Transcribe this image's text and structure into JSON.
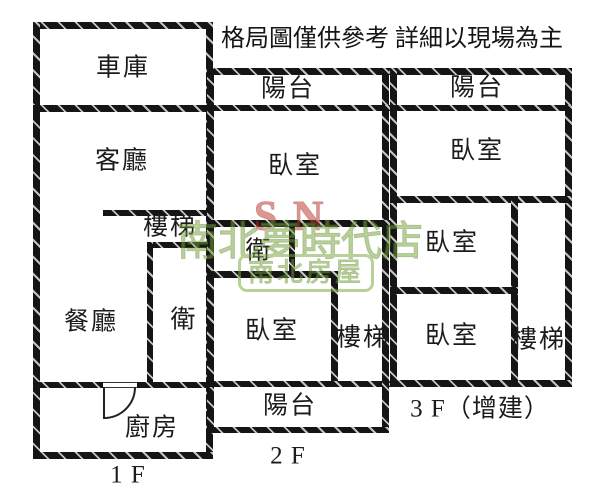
{
  "title": "格局圖僅供參考 詳細以現場為主",
  "floors": {
    "f1": {
      "label": "1 F",
      "rooms": {
        "garage": "車庫",
        "living_room": "客廳",
        "stairs": "樓梯",
        "dining_room": "餐廳",
        "bathroom": "衛",
        "kitchen": "廚房"
      }
    },
    "f2": {
      "label": "2 F",
      "rooms": {
        "balcony_top": "陽台",
        "bedroom_upper": "臥室",
        "bathroom": "衛",
        "bedroom_lower": "臥室",
        "stairs": "樓梯",
        "balcony_bottom": "陽台"
      }
    },
    "f3": {
      "label": "3 F（增建）",
      "rooms": {
        "balcony": "陽台",
        "bedroom_upper": "臥室",
        "bedroom_middle": "臥室",
        "bedroom_lower": "臥室",
        "stairs": "樓梯"
      }
    }
  },
  "watermark": {
    "letter_s": "S",
    "letter_n": "N",
    "line1": "南北夢時代店",
    "line2": "南北房屋",
    "red": "#c0392b",
    "green": "#7aa93c"
  },
  "colors": {
    "wall": "#151515",
    "background": "#ffffff",
    "text": "#1b1b1b"
  }
}
